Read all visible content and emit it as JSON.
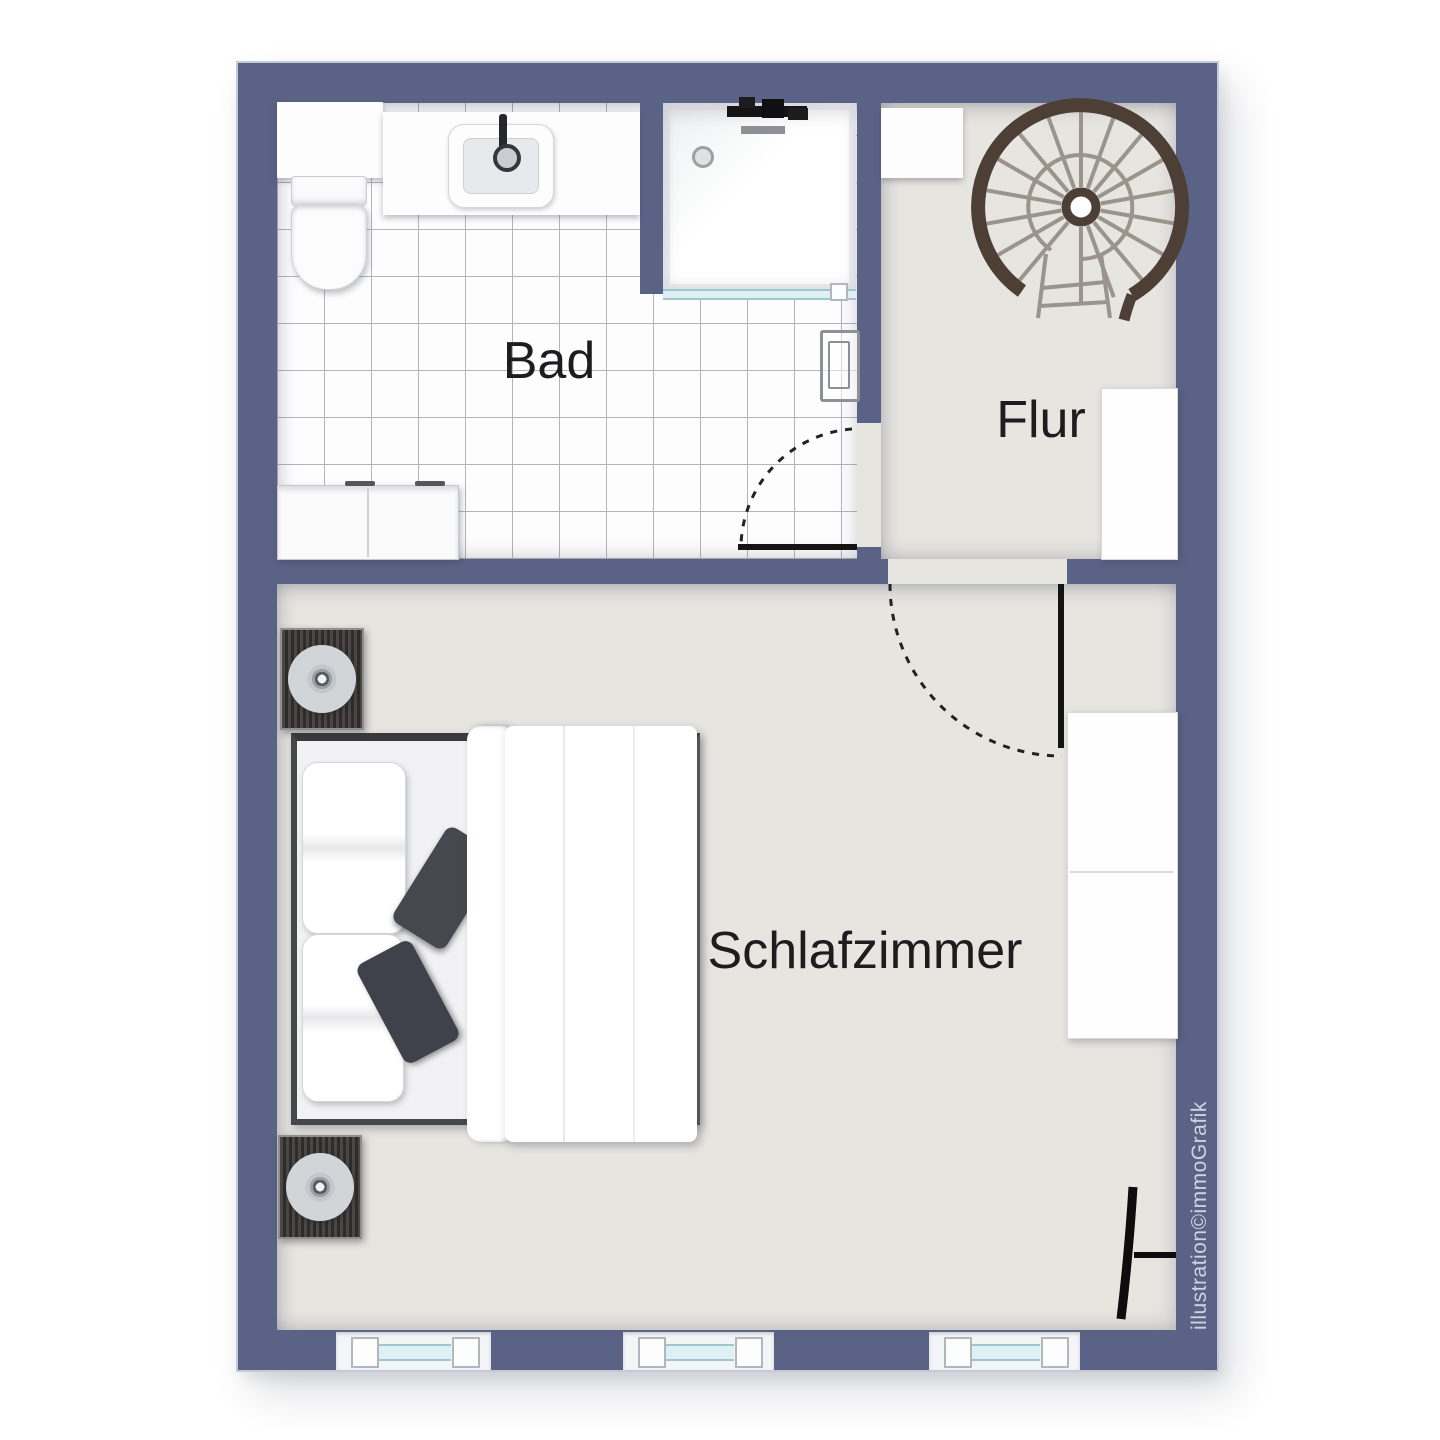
{
  "rooms": [
    {
      "id": "bad",
      "label": "Bad"
    },
    {
      "id": "flur",
      "label": "Flur"
    },
    {
      "id": "schlafzimmer",
      "label": "Schlafzimmer"
    }
  ],
  "watermark": {
    "text": "illustration©immoGrafik"
  },
  "colors": {
    "wall": "#5a6286",
    "wall_edge": "#c6cad8",
    "floor": "#e7e5e0",
    "tile": "#fdfdfe",
    "grout": "#b4b4b8",
    "label": "#1d1d1f",
    "stair_band": "#4e3f36",
    "stair_step": "#9b948d",
    "glass_fill": "#def0f4",
    "glass_line": "#9fc6cf",
    "door": "#141414",
    "pillow_dark": "#45484e",
    "watermark": "#d7dae4",
    "speaker_body": "#3b3938",
    "metal": "#8d9196",
    "background": "#ffffff"
  },
  "fixtures": [
    {
      "id": "toilet",
      "room": "Bad"
    },
    {
      "id": "washbasin",
      "room": "Bad"
    },
    {
      "id": "shower",
      "room": "Bad"
    },
    {
      "id": "towel-radiator",
      "room": "Bad"
    },
    {
      "id": "bathroom-cabinet",
      "room": "Bad"
    },
    {
      "id": "bathroom-shelf",
      "room": "Bad"
    },
    {
      "id": "bathroom-door",
      "room": "Bad"
    },
    {
      "id": "spiral-staircase",
      "room": "Flur"
    },
    {
      "id": "hall-shelf",
      "room": "Flur"
    },
    {
      "id": "hall-cabinet",
      "room": "Flur"
    },
    {
      "id": "bedroom-door",
      "room": "Schlafzimmer"
    },
    {
      "id": "double-bed",
      "room": "Schlafzimmer"
    },
    {
      "id": "duvet",
      "room": "Schlafzimmer"
    },
    {
      "id": "speaker-top",
      "room": "Schlafzimmer"
    },
    {
      "id": "speaker-bottom",
      "room": "Schlafzimmer"
    },
    {
      "id": "wardrobe",
      "room": "Schlafzimmer"
    },
    {
      "id": "terrace-door",
      "room": "Schlafzimmer"
    },
    {
      "id": "window-1",
      "room": "Schlafzimmer"
    },
    {
      "id": "window-2",
      "room": "Schlafzimmer"
    },
    {
      "id": "window-3",
      "room": "Schlafzimmer"
    }
  ]
}
